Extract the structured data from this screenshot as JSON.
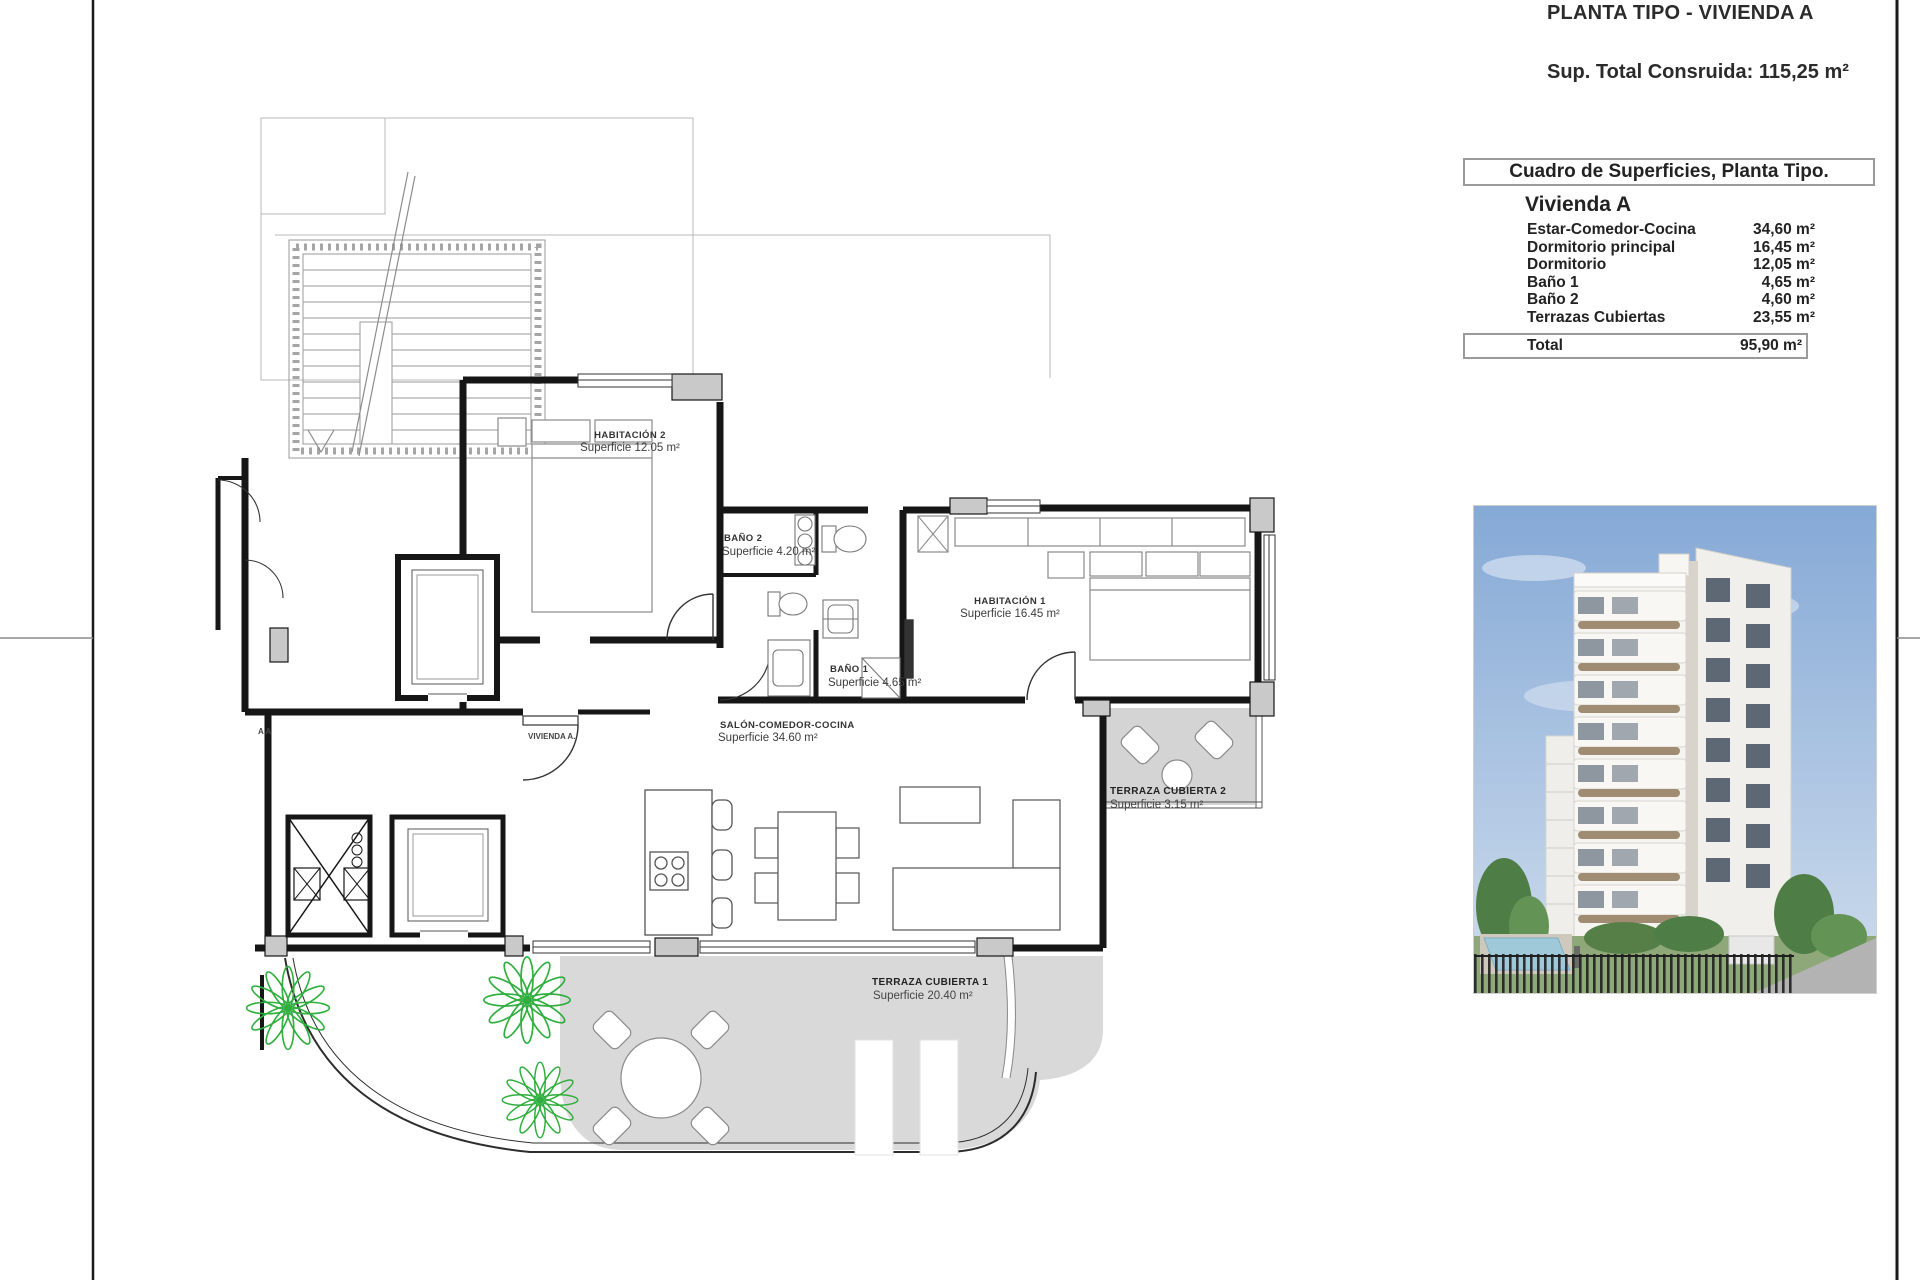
{
  "header": {
    "title": "PLANTA TIPO - VIVIENDA A",
    "total_built": "Sup. Total Consruida: 115,25 m²"
  },
  "surface_table": {
    "title": "Cuadro de Superficies, Planta Tipo.",
    "unit": "Vivienda A",
    "rows": [
      {
        "label": "Estar-Comedor-Cocina",
        "value": "34,60 m²"
      },
      {
        "label": "Dormitorio principal",
        "value": "16,45 m²"
      },
      {
        "label": "Dormitorio",
        "value": "12,05 m²"
      },
      {
        "label": "Baño 1",
        "value": "4,65 m²"
      },
      {
        "label": "Baño 2",
        "value": "4,60 m²"
      },
      {
        "label": "Terrazas Cubiertas",
        "value": "23,55 m²"
      }
    ],
    "total_label": "Total",
    "total_value": "95,90 m²"
  },
  "floor_plan": {
    "unit_label": "VIVIENDA A.",
    "section_label": "A A",
    "rooms": [
      {
        "name": "HABITACIÓN 2",
        "area": "Superficie 12.05 m²"
      },
      {
        "name": "BAÑO 2",
        "area": "Superficie 4.20 m²"
      },
      {
        "name": "HABITACIÓN 1",
        "area": "Superficie 16.45 m²"
      },
      {
        "name": "BAÑO 1",
        "area": "Superficie 4.65 m²"
      },
      {
        "name": "SALÓN-COMEDOR-COCINA",
        "area": "Superficie 34.60 m²"
      },
      {
        "name": "TERRAZA CUBIERTA 2",
        "area": "Superficie 3.15 m²"
      },
      {
        "name": "TERRAZA CUBIERTA 1",
        "area": "Superficie 20.40 m²"
      }
    ]
  },
  "photo": {
    "name": "building-render"
  },
  "colors": {
    "wall": "#161616",
    "terrace_fill": "#d9d9d9",
    "plant_green": "#2fae3e",
    "pillar_gray": "#c9c9c9",
    "sky_top": "#85a9d6",
    "sky_bottom": "#cfdded"
  }
}
